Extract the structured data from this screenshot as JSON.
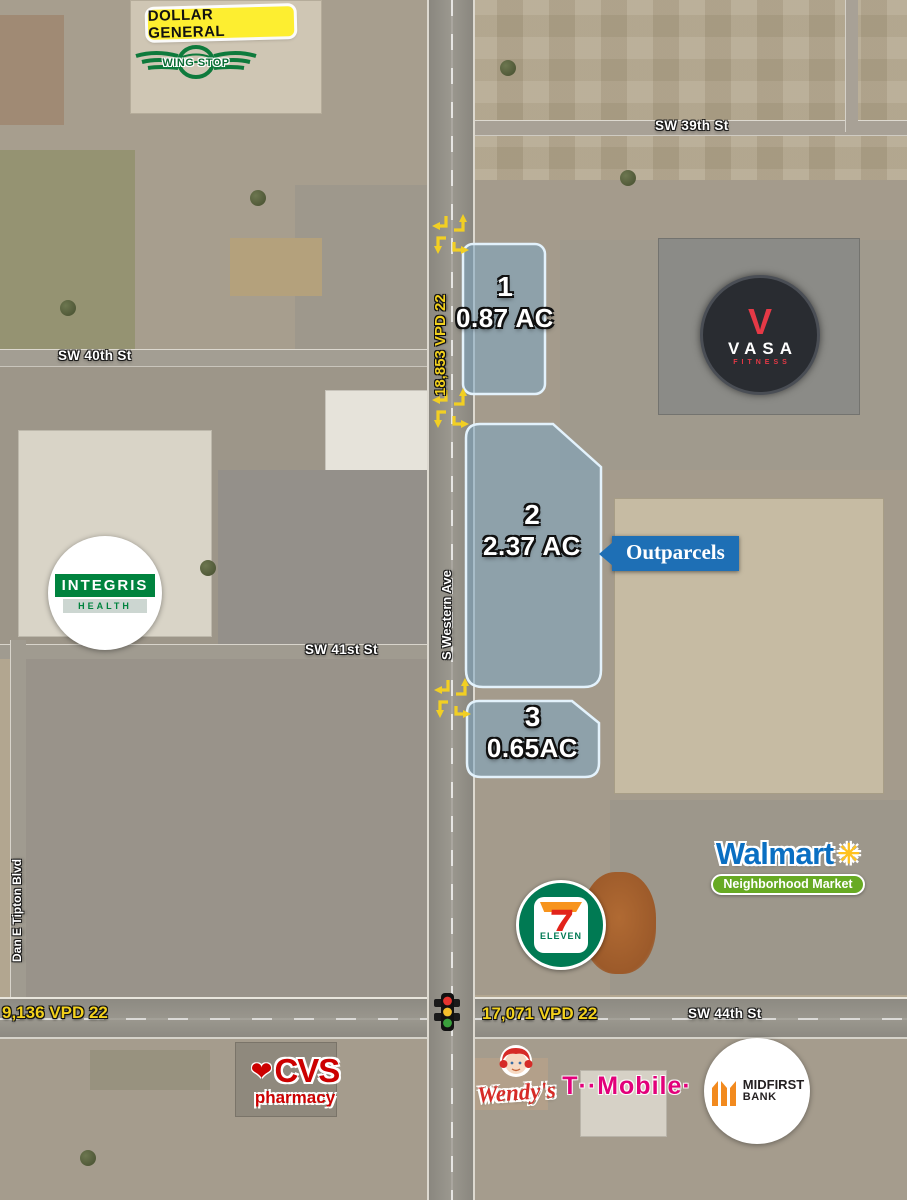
{
  "streets": {
    "sw39": "SW 39th St",
    "sw40": "SW 40th St",
    "sw41": "SW 41st St",
    "sw44": "SW 44th St",
    "western": "S Western Ave",
    "tipton": "Dan E Tipton Blvd"
  },
  "traffic_counts": {
    "western": "18,853 VPD 22",
    "sw44_west": "9,136 VPD 22",
    "sw44_east": "17,071 VPD 22"
  },
  "parcels": [
    {
      "number": "1",
      "acreage": "0.87 AC"
    },
    {
      "number": "2",
      "acreage": "2.37 AC"
    },
    {
      "number": "3",
      "acreage": "0.65AC"
    }
  ],
  "callout": {
    "label": "Outparcels"
  },
  "logos": {
    "dollar_general": {
      "name": "DOLLAR GENERAL"
    },
    "wingstop": {
      "name": "WING STOP"
    },
    "vasa": {
      "initial": "V",
      "name": "VASA",
      "tagline": "FITNESS"
    },
    "integris": {
      "name": "INTEGRIS",
      "tagline": "HEALTH"
    },
    "walmart": {
      "name": "Walmart",
      "spark": "✳",
      "tagline": "Neighborhood Market"
    },
    "seven_eleven": {
      "seven": "7",
      "eleven": "ELEVEN"
    },
    "cvs": {
      "heart": "❤",
      "name": "CVS",
      "tagline": "pharmacy"
    },
    "wendys": {
      "name": "Wendy's"
    },
    "tmobile": {
      "name": "T··Mobile·"
    },
    "midfirst": {
      "name": "MIDFIRST",
      "name2": "BANK"
    }
  },
  "colors": {
    "parcel-fill": "#7ca6c2",
    "parcel-stroke": "#e3f2fc",
    "callout-blue": "#1e6fb5",
    "vpd-yellow": "#f3d11d",
    "arrow-yellow": "#f2cf23",
    "dg-yellow": "#fdee30",
    "ws-green": "#0e7a3c",
    "vasa-red": "#e63946",
    "vasa-dark": "#292c31",
    "integris-green": "#00833e",
    "wm-blue": "#0a6fc2",
    "wm-yellow": "#ffc220",
    "wm-green": "#67aa23",
    "se-green": "#007a53",
    "se-orange": "#f7941d",
    "se-red": "#e2231a",
    "cvs-red": "#cc0000",
    "wendys-red": "#d62b27",
    "tm-magenta": "#e2007a",
    "mf-orange": "#f28a1e"
  }
}
